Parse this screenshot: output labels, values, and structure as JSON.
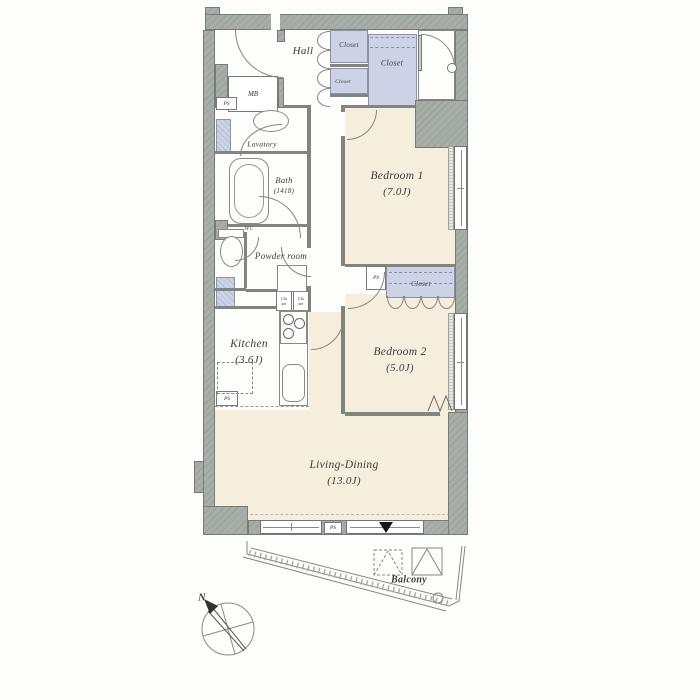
{
  "colors": {
    "wall": "#a7aea8",
    "wallDark": "#99a19a",
    "floor": "#f6eedd",
    "closet": "#cdd3e6",
    "closetDark": "#b3bad4",
    "line": "#80867f"
  },
  "rooms": {
    "hall": {
      "label": "Hall"
    },
    "bedroom1": {
      "label": "Bedroom 1",
      "size": "(7.0J)"
    },
    "bedroom2": {
      "label": "Bedroom 2",
      "size": "(5.0J)"
    },
    "living_dining": {
      "label": "Living-Dining",
      "size": "(13.0J)"
    },
    "kitchen": {
      "label": "Kitchen",
      "size": "(3.6J)"
    },
    "bath": {
      "label": "Bath",
      "size": "(1418)"
    },
    "lavatory": {
      "label": "Lavatory"
    },
    "powder_room": {
      "label": "Powder room"
    },
    "wc": {
      "label": "WC"
    },
    "balcony": {
      "label": "Balcony"
    }
  },
  "storage": {
    "closet_hall_upper": "Closet",
    "closet_hall_lower": "Closet",
    "closet_entry": "Closet",
    "closet_bedroom2": "Closet",
    "closet_small_line1": "Clo",
    "closet_small_line2": "set"
  },
  "utility": {
    "mb": "MB",
    "ps": "PS"
  },
  "compass": {
    "north": "N"
  }
}
